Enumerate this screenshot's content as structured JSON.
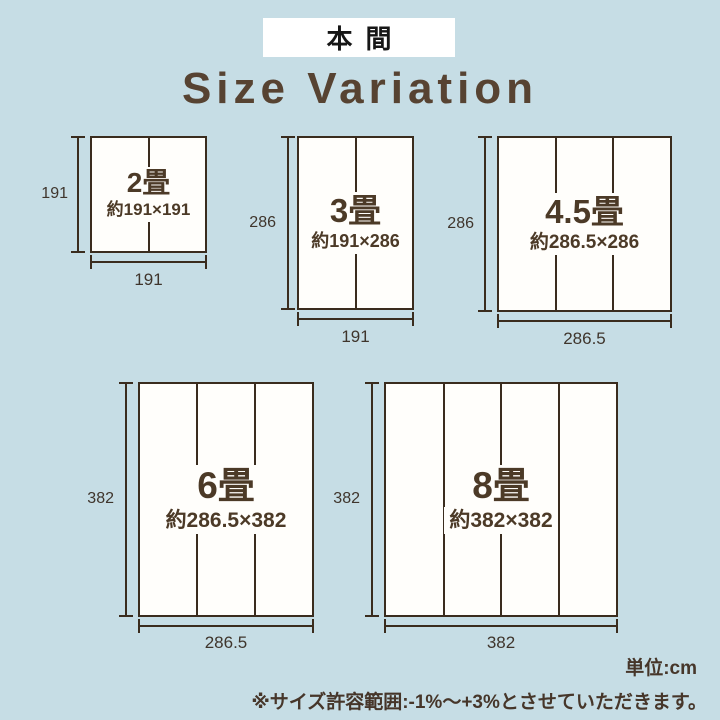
{
  "header": {
    "standard_label": "本間"
  },
  "title": "Size Variation",
  "sizes": [
    {
      "name": "2畳",
      "dimensions": "約191×191",
      "width_label": "191",
      "height_label": "191",
      "panels": 2
    },
    {
      "name": "3畳",
      "dimensions": "約191×286",
      "width_label": "191",
      "height_label": "286",
      "panels": 2
    },
    {
      "name": "4.5畳",
      "dimensions": "約286.5×286",
      "width_label": "286.5",
      "height_label": "286",
      "panels": 3
    },
    {
      "name": "6畳",
      "dimensions": "約286.5×382",
      "width_label": "286.5",
      "height_label": "382",
      "panels": 3
    },
    {
      "name": "8畳",
      "dimensions": "約382×382",
      "width_label": "382",
      "height_label": "382",
      "panels": 4
    }
  ],
  "footer": {
    "unit_label": "単位:cm",
    "tolerance_note": "※サイズ許容範囲:-1%〜+3%とさせていただきます。"
  },
  "colors": {
    "background": "#c6dde5",
    "ink": "#3a2c1e",
    "label_brown": "#4c3a27",
    "title_brown": "#574332",
    "panel_white": "#fffefb"
  }
}
